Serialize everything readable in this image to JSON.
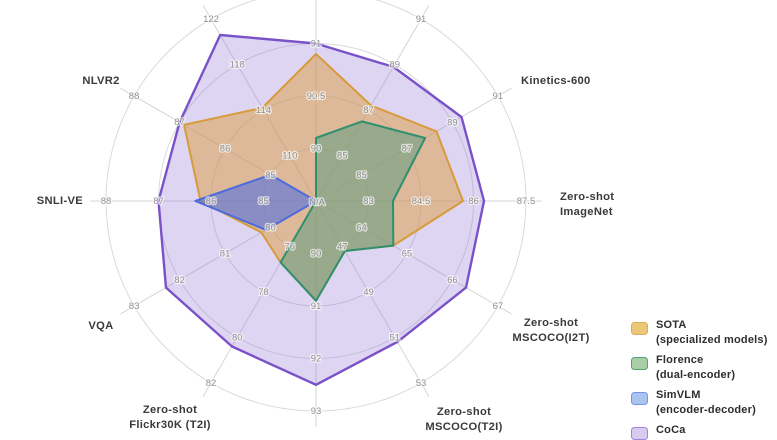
{
  "figure": {
    "center_na_label": "N/A"
  },
  "chart_data": {
    "type": "radar",
    "grid": {
      "rings": 4,
      "shape": "circular",
      "axes_count": 12
    },
    "legend_position": "bottom-right",
    "axes": [
      {
        "id": "imagenet",
        "label_lines": [],
        "min": 89.5,
        "step": 0.5,
        "ticks": [
          "90",
          "90.5",
          "91"
        ]
      },
      {
        "id": "kinetics-400",
        "label_lines": [],
        "min": 83,
        "step": 2,
        "ticks": [
          "85",
          "87",
          "89",
          "91"
        ]
      },
      {
        "id": "kinetics-600",
        "label_lines": [
          "Kinetics-600"
        ],
        "min": 83,
        "step": 2,
        "ticks": [
          "85",
          "87",
          "89",
          "91"
        ]
      },
      {
        "id": "zero-shot-imagenet",
        "label_lines": [
          "Zero-shot",
          "ImageNet"
        ],
        "min": 81.5,
        "step": 1.5,
        "ticks": [
          "83",
          "84.5",
          "86",
          "87.5"
        ]
      },
      {
        "id": "zero-shot-mscoco-i2t",
        "label_lines": [
          "Zero-shot",
          "MSCOCO(I2T)"
        ],
        "min": 63,
        "step": 1,
        "ticks": [
          "64",
          "65",
          "66",
          "67"
        ]
      },
      {
        "id": "zero-shot-mscoco-t2i",
        "label_lines": [
          "Zero-shot",
          "MSCOCO(T2I)"
        ],
        "min": 45,
        "step": 2,
        "ticks": [
          "47",
          "49",
          "51",
          "53"
        ]
      },
      {
        "id": "zero-shot-flickr30k-i2t",
        "label_lines": [],
        "min": 89,
        "step": 1,
        "ticks": [
          "90",
          "91",
          "92",
          "93"
        ]
      },
      {
        "id": "zero-shot-flickr30k-t2i",
        "label_lines": [
          "Zero-shot",
          "Flickr30K (T2I)"
        ],
        "min": 74,
        "step": 2,
        "ticks": [
          "76",
          "78",
          "80",
          "82"
        ]
      },
      {
        "id": "vqa",
        "label_lines": [
          "VQA"
        ],
        "min": 79,
        "step": 1,
        "ticks": [
          "80",
          "81",
          "82",
          "83"
        ]
      },
      {
        "id": "snli-ve",
        "label_lines": [
          "SNLI-VE"
        ],
        "min": 84,
        "step": 1,
        "ticks": [
          "85",
          "86",
          "87",
          "88"
        ]
      },
      {
        "id": "nlvr2",
        "label_lines": [
          "NLVR2"
        ],
        "min": 84,
        "step": 1,
        "ticks": [
          "85",
          "86",
          "87",
          "88"
        ]
      },
      {
        "id": "nocaps",
        "label_lines": [],
        "min": 106,
        "step": 4,
        "ticks": [
          "110",
          "114",
          "118",
          "122"
        ]
      }
    ],
    "series": [
      {
        "name": "SOTA (specialized models)",
        "stroke": "#d79b3c",
        "fill": "rgba(219,158,64,0.50)",
        "values": [
          90.9,
          87.2,
          88.3,
          85.7,
          64.7,
          47.2,
          90.9,
          76.7,
          80.2,
          86.2,
          86.9,
          114.2
        ]
      },
      {
        "name": "Florence (dual-encoder)",
        "stroke": "#2f8f6f",
        "fill": "rgba(88,158,126,0.52)",
        "values": [
          90.1,
          86.5,
          87.8,
          83.7,
          64.7,
          47.2,
          90.9,
          76.7,
          null,
          null,
          null,
          null
        ]
      },
      {
        "name": "SimVLM (encoder-decoder)",
        "stroke": "#4e6bdb",
        "fill": "rgba(70,105,230,0.55)",
        "values": [
          null,
          null,
          null,
          null,
          null,
          null,
          null,
          null,
          80.1,
          86.3,
          85.0,
          null
        ]
      },
      {
        "name": "CoCa",
        "stroke": "#7a52c8",
        "fill": "rgba(147,117,215,0.30)",
        "values": [
          91.0,
          88.9,
          89.4,
          86.3,
          66.3,
          51.2,
          92.5,
          80.4,
          82.3,
          87.0,
          87.0,
          120.6
        ]
      }
    ],
    "center_label": "N/A",
    "tick_color": "#8f8f8f",
    "axis_label_color": "#3a3a3a"
  },
  "legend": {
    "items": [
      {
        "line1": "SOTA",
        "line2": "(specialized models)",
        "fill": "#ebc878",
        "stroke": "#d9ae54"
      },
      {
        "line1": "Florence",
        "line2": "(dual-encoder)",
        "fill": "#a9cfa6",
        "stroke": "#53a076"
      },
      {
        "line1": "SimVLM",
        "line2": "(encoder-decoder)",
        "fill": "#a9c4f0",
        "stroke": "#7296e3"
      },
      {
        "line1": "CoCa",
        "line2": "",
        "fill": "#d8cbf2",
        "stroke": "#9f84d8"
      }
    ]
  }
}
